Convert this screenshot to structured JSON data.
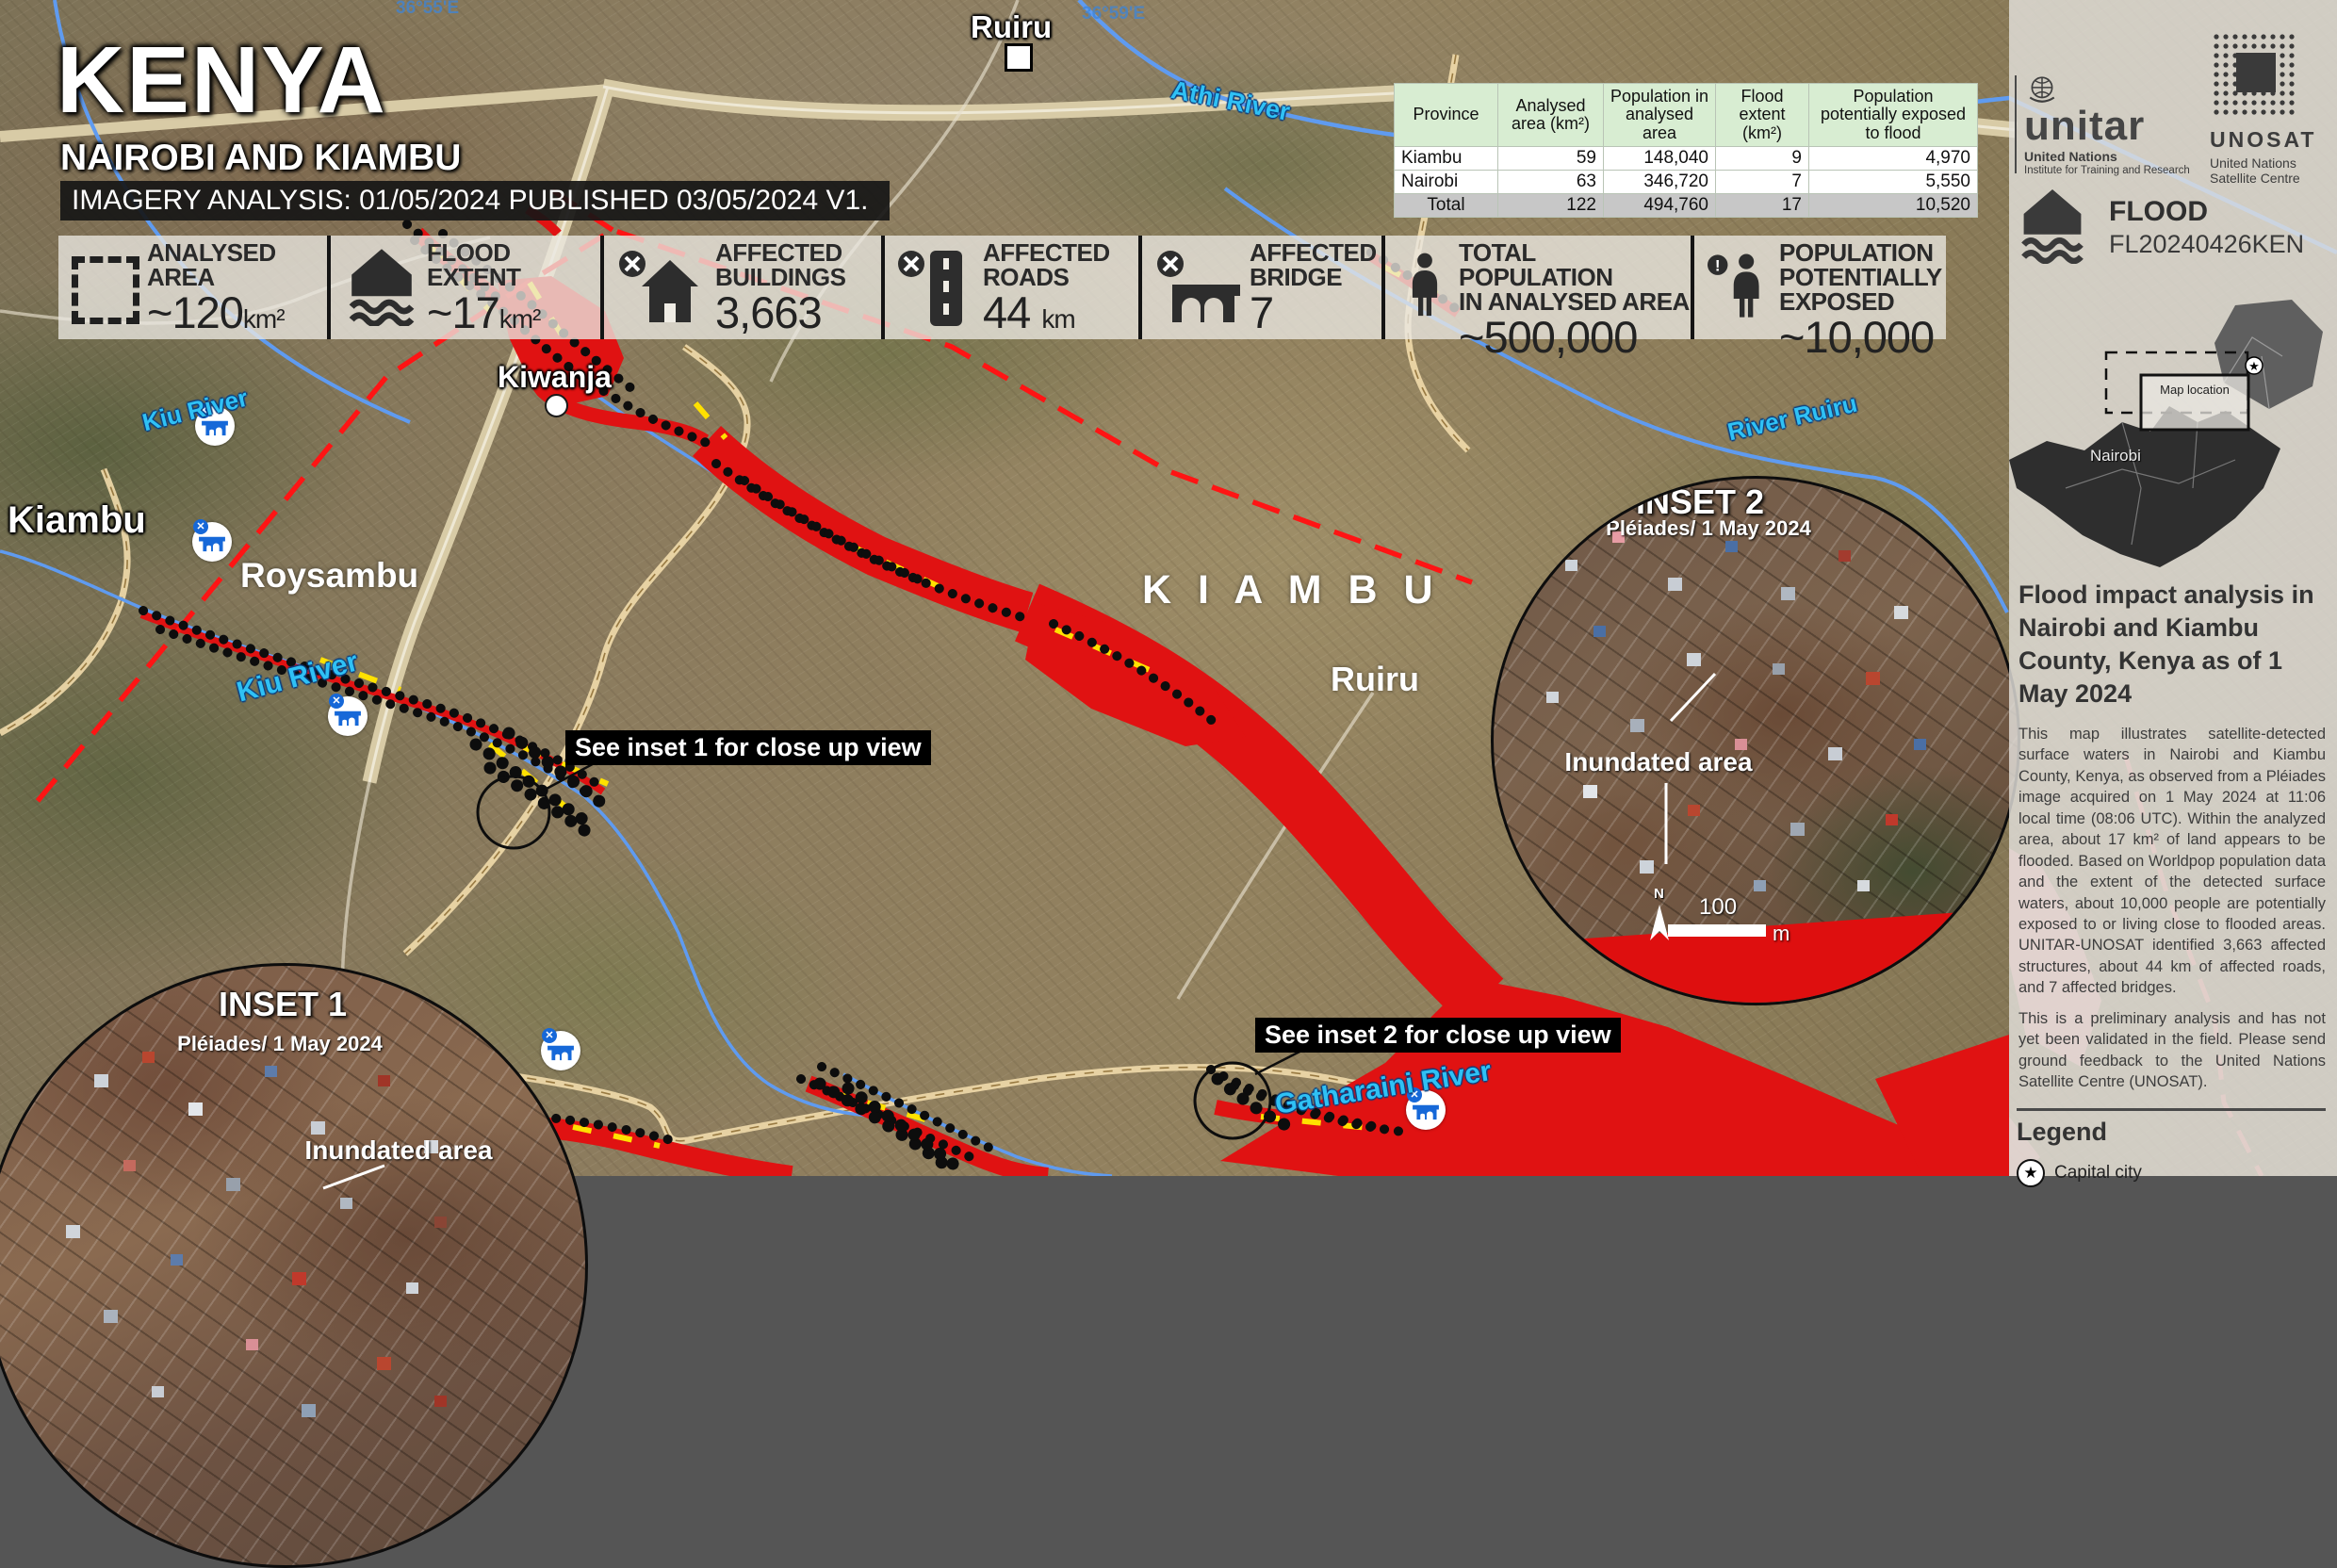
{
  "title": {
    "country": "KENYA",
    "region": "NAIROBI AND KIAMBU",
    "analysis": "IMAGERY ANALYSIS: 01/05/2024 PUBLISHED 03/05/2024 V1."
  },
  "stats": {
    "items": [
      {
        "icon": "analysed-area-icon",
        "label": "ANALYSED\nAREA",
        "value": "~120",
        "unit": "km²"
      },
      {
        "icon": "flood-extent-icon",
        "label": "FLOOD\nEXTENT",
        "value": "~17",
        "unit": "km²"
      },
      {
        "icon": "affected-buildings-icon",
        "label": "AFFECTED\nBUILDINGS",
        "value": "3,663",
        "unit": ""
      },
      {
        "icon": "affected-roads-icon",
        "label": "AFFECTED\nROADS",
        "value": "44",
        "unit": "km"
      },
      {
        "icon": "affected-bridge-icon",
        "label": "AFFECTED\nBRIDGE",
        "value": "7",
        "unit": ""
      },
      {
        "icon": "total-population-icon",
        "label": "TOTAL POPULATION\nIN ANALYSED AREA",
        "value": "~500,000",
        "unit": ""
      },
      {
        "icon": "population-exposed-icon",
        "label": "POPULATION\nPOTENTIALLY\nEXPOSED",
        "value": "~10,000",
        "unit": ""
      }
    ]
  },
  "table": {
    "headers": [
      "Province",
      "Analysed area (km²)",
      "Population in analysed area",
      "Flood extent (km²)",
      "Population potentially exposed to flood"
    ],
    "rows": [
      [
        "Kiambu",
        "59",
        "148,040",
        "9",
        "4,970"
      ],
      [
        "Nairobi",
        "63",
        "346,720",
        "7",
        "5,550"
      ]
    ],
    "total": [
      "Total",
      "122",
      "494,760",
      "17",
      "10,520"
    ]
  },
  "map": {
    "graticule": [
      {
        "t": "36°55'E"
      },
      {
        "t": "36°59'E"
      }
    ],
    "places": {
      "ruiru_top": "Ruiru",
      "kiwanja": "Kiwanja",
      "kiambu_town": "Kiambu",
      "roysambu": "Roysambu",
      "kiambu_county": "K I A M B U",
      "ruiru_mid": "Ruiru"
    },
    "rivers": {
      "athi": "Athi River",
      "ruiru": "River Ruiru",
      "kiu_a": "Kiu River",
      "kiu_b": "Kiu River",
      "gatharaini": "Gatharaini River"
    },
    "callouts": {
      "inset1": "See inset 1 for close up view",
      "inset2": "See inset 2 for close up view"
    }
  },
  "insets": [
    {
      "name": "INSET 1",
      "source": "Pléiades/ 1 May 2024",
      "note": "Inundated area"
    },
    {
      "name": "INSET 2",
      "source": "Pléiades/ 1 May 2024",
      "note": "Inundated area",
      "scale_value": "100",
      "scale_unit": "m",
      "north": "N"
    }
  ],
  "sidebar": {
    "unitar": {
      "wordmark": "unitar",
      "line1": "United Nations",
      "line2": "Institute for Training and Research"
    },
    "unosat": {
      "wordmark": "UNOSAT",
      "line1": "United Nations",
      "line2": "Satellite Centre"
    },
    "event": {
      "type": "FLOOD",
      "code": "FL20240426KEN"
    },
    "minimap": {
      "label": "Map location",
      "city": "Nairobi"
    },
    "heading": "Flood impact analysis in Nairobi and Kiambu County, Kenya as of 1 May 2024",
    "para1": "This map illustrates satellite-detected surface waters in Nairobi and Kiambu County, Kenya, as observed from a Pléiades image acquired on 1 May 2024 at 11:06 local time (08:06 UTC). Within the analyzed area, about 17 km² of land appears to be flooded. Based on Worldpop population data and the extent of the detected surface waters, about 10,000 people are potentially exposed to or living close to flooded areas. UNITAR-UNOSAT identified 3,663 affected structures, about 44 km of affected roads, and 7 affected bridges.",
    "para2": "This is a preliminary analysis and has not yet been validated in the field. Please send ground feedback to the United Nations Satellite Centre (UNOSAT).",
    "legend_title": "Legend",
    "legend_items": [
      {
        "label": "Capital city"
      }
    ]
  }
}
